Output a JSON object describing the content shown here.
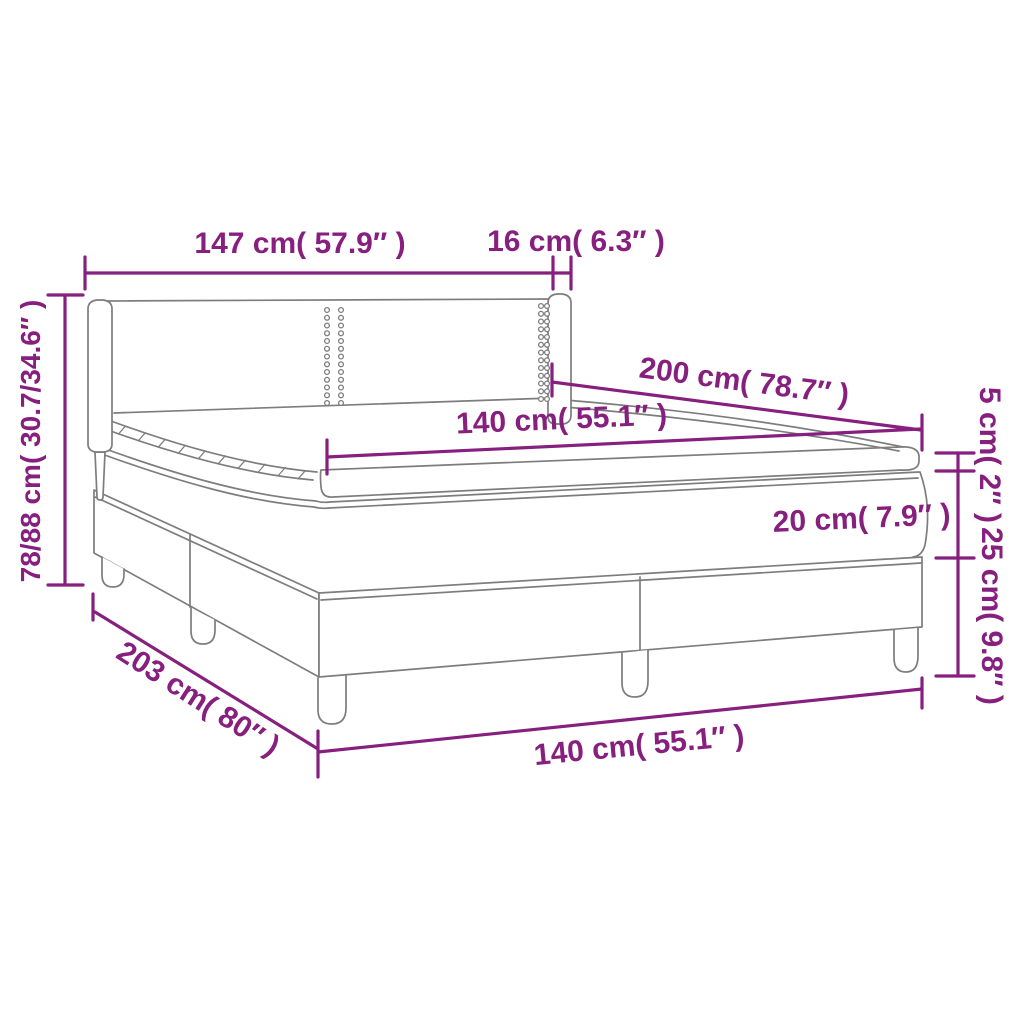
{
  "diagram": {
    "title": "box-spring-bed-dimension-diagram",
    "accent_color": "#871F7E",
    "outline_color": "#7D7D7D",
    "labels": {
      "headboard_width": "147 cm( 57.9″ )",
      "headboard_wing_depth": "16 cm( 6.3″ )",
      "headboard_height": "78/88 cm( 30.7/34.6″ )",
      "mattress_length": "200 cm( 78.7″ )",
      "mattress_width_top": "140 cm( 55.1″ )",
      "pillow_top_height": "5 cm( 2″ )",
      "mattress_height": "20 cm( 7.9″ )",
      "base_height": "25 cm( 9.8″ )",
      "base_length": "203 cm( 80″ )",
      "mattress_width_bottom": "140 cm( 55.1″ )"
    }
  }
}
